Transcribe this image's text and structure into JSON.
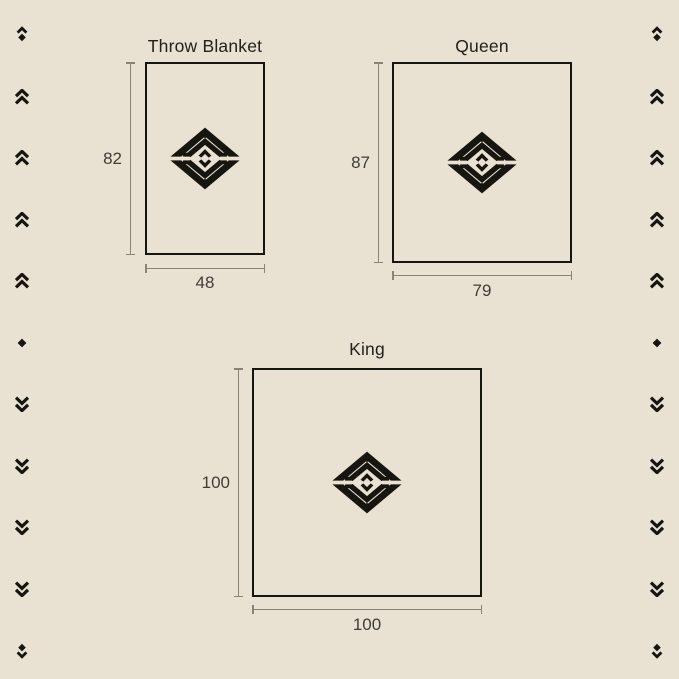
{
  "canvas": {
    "background_color": "#e9e2d2",
    "ink_color": "#17150f",
    "dimension_line_color": "#8b8375",
    "label_color": "#403d35"
  },
  "sections": [
    {
      "title": "Throw Blanket",
      "height_label": "82",
      "width_label": "48"
    },
    {
      "title": "Queen",
      "height_label": "87",
      "width_label": "79"
    },
    {
      "title": "King",
      "height_label": "100",
      "width_label": "100"
    }
  ],
  "logo": {
    "name": "diamond-chevron-emblem"
  },
  "side_decorations": {
    "left": [
      "chevron-up-over-diamond",
      "double-chevron-up",
      "double-chevron-up",
      "double-chevron-up",
      "double-chevron-up",
      "diamond",
      "double-chevron-down",
      "double-chevron-down",
      "double-chevron-down",
      "double-chevron-down",
      "diamond-over-chevron-down"
    ],
    "right": [
      "chevron-up-over-diamond",
      "double-chevron-up",
      "double-chevron-up",
      "double-chevron-up",
      "double-chevron-up",
      "diamond",
      "double-chevron-down",
      "double-chevron-down",
      "double-chevron-down",
      "double-chevron-down",
      "diamond-over-chevron-down"
    ]
  }
}
